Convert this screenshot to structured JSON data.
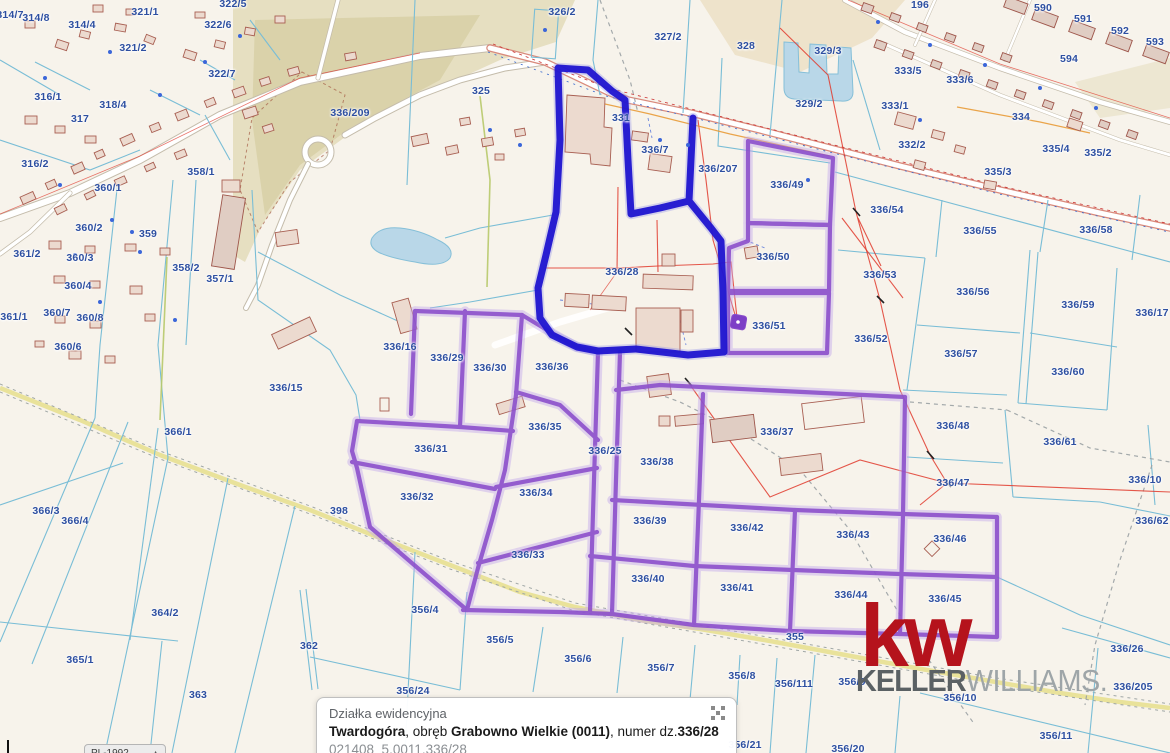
{
  "map": {
    "selected_parcel": "336/28",
    "selected_outline_color": "#1f14d0",
    "related_outline_color": "#8a4dcb",
    "label_color": "#2d4fa1",
    "labels": [
      {
        "t": "314/7",
        "x": 10,
        "y": 15
      },
      {
        "t": "314/8",
        "x": 36,
        "y": 18
      },
      {
        "t": "314/4",
        "x": 82,
        "y": 25
      },
      {
        "t": "321/1",
        "x": 145,
        "y": 12
      },
      {
        "t": "322/5",
        "x": 233,
        "y": 4
      },
      {
        "t": "322/6",
        "x": 218,
        "y": 25
      },
      {
        "t": "321/2",
        "x": 133,
        "y": 48
      },
      {
        "t": "322/7",
        "x": 222,
        "y": 74
      },
      {
        "t": "316/1",
        "x": 48,
        "y": 97
      },
      {
        "t": "318/4",
        "x": 113,
        "y": 105
      },
      {
        "t": "317",
        "x": 80,
        "y": 119
      },
      {
        "t": "316/2",
        "x": 35,
        "y": 164
      },
      {
        "t": "358/1",
        "x": 201,
        "y": 172
      },
      {
        "t": "360/1",
        "x": 108,
        "y": 188
      },
      {
        "t": "360/2",
        "x": 89,
        "y": 228
      },
      {
        "t": "359",
        "x": 148,
        "y": 234
      },
      {
        "t": "361/2",
        "x": 27,
        "y": 254
      },
      {
        "t": "360/3",
        "x": 80,
        "y": 258
      },
      {
        "t": "358/2",
        "x": 186,
        "y": 268
      },
      {
        "t": "357/1",
        "x": 220,
        "y": 279
      },
      {
        "t": "360/4",
        "x": 78,
        "y": 286
      },
      {
        "t": "360/7",
        "x": 57,
        "y": 313
      },
      {
        "t": "360/8",
        "x": 90,
        "y": 318
      },
      {
        "t": "361/1",
        "x": 14,
        "y": 317
      },
      {
        "t": "360/6",
        "x": 68,
        "y": 347
      },
      {
        "t": "336/15",
        "x": 286,
        "y": 388
      },
      {
        "t": "366/1",
        "x": 178,
        "y": 432
      },
      {
        "t": "366/3",
        "x": 46,
        "y": 511
      },
      {
        "t": "366/4",
        "x": 75,
        "y": 521
      },
      {
        "t": "364/2",
        "x": 165,
        "y": 613
      },
      {
        "t": "365/1",
        "x": 80,
        "y": 660
      },
      {
        "t": "362",
        "x": 309,
        "y": 646
      },
      {
        "t": "363",
        "x": 198,
        "y": 695
      },
      {
        "t": "398",
        "x": 339,
        "y": 511
      },
      {
        "t": "336/209",
        "x": 350,
        "y": 113
      },
      {
        "t": "325",
        "x": 481,
        "y": 91
      },
      {
        "t": "326/2",
        "x": 562,
        "y": 12
      },
      {
        "t": "327/2",
        "x": 668,
        "y": 37
      },
      {
        "t": "328",
        "x": 746,
        "y": 46
      },
      {
        "t": "329/2",
        "x": 809,
        "y": 104
      },
      {
        "t": "331",
        "x": 621,
        "y": 118
      },
      {
        "t": "336/7",
        "x": 655,
        "y": 150
      },
      {
        "t": "336/207",
        "x": 718,
        "y": 169
      },
      {
        "t": "336/49",
        "x": 787,
        "y": 185
      },
      {
        "t": "336/50",
        "x": 773,
        "y": 257
      },
      {
        "t": "336/51",
        "x": 769,
        "y": 326
      },
      {
        "t": "336/28",
        "x": 622,
        "y": 272
      },
      {
        "t": "196",
        "x": 920,
        "y": 5
      },
      {
        "t": "590",
        "x": 1043,
        "y": 8
      },
      {
        "t": "591",
        "x": 1083,
        "y": 19
      },
      {
        "t": "592",
        "x": 1120,
        "y": 31
      },
      {
        "t": "593",
        "x": 1155,
        "y": 42
      },
      {
        "t": "594",
        "x": 1069,
        "y": 59
      },
      {
        "t": "329/3",
        "x": 828,
        "y": 51
      },
      {
        "t": "333/5",
        "x": 908,
        "y": 71
      },
      {
        "t": "333/6",
        "x": 960,
        "y": 80
      },
      {
        "t": "333/1",
        "x": 895,
        "y": 106
      },
      {
        "t": "334",
        "x": 1021,
        "y": 117
      },
      {
        "t": "332/2",
        "x": 912,
        "y": 145
      },
      {
        "t": "335/4",
        "x": 1056,
        "y": 149
      },
      {
        "t": "335/2",
        "x": 1098,
        "y": 153
      },
      {
        "t": "335/3",
        "x": 998,
        "y": 172
      },
      {
        "t": "336/54",
        "x": 887,
        "y": 210
      },
      {
        "t": "336/55",
        "x": 980,
        "y": 231
      },
      {
        "t": "336/58",
        "x": 1096,
        "y": 230
      },
      {
        "t": "336/53",
        "x": 880,
        "y": 275
      },
      {
        "t": "336/56",
        "x": 973,
        "y": 292
      },
      {
        "t": "336/59",
        "x": 1078,
        "y": 305
      },
      {
        "t": "336/17",
        "x": 1152,
        "y": 313
      },
      {
        "t": "336/52",
        "x": 871,
        "y": 339
      },
      {
        "t": "336/57",
        "x": 961,
        "y": 354
      },
      {
        "t": "336/60",
        "x": 1068,
        "y": 372
      },
      {
        "t": "336/16",
        "x": 400,
        "y": 347
      },
      {
        "t": "336/29",
        "x": 447,
        "y": 358
      },
      {
        "t": "336/30",
        "x": 490,
        "y": 368
      },
      {
        "t": "336/36",
        "x": 552,
        "y": 367
      },
      {
        "t": "336/35",
        "x": 545,
        "y": 427
      },
      {
        "t": "336/31",
        "x": 431,
        "y": 449
      },
      {
        "t": "336/25",
        "x": 605,
        "y": 451
      },
      {
        "t": "336/38",
        "x": 657,
        "y": 462
      },
      {
        "t": "336/37",
        "x": 777,
        "y": 432
      },
      {
        "t": "336/48",
        "x": 953,
        "y": 426
      },
      {
        "t": "336/47",
        "x": 953,
        "y": 483
      },
      {
        "t": "336/61",
        "x": 1060,
        "y": 442
      },
      {
        "t": "336/10",
        "x": 1145,
        "y": 480
      },
      {
        "t": "336/62",
        "x": 1152,
        "y": 521
      },
      {
        "t": "336/32",
        "x": 417,
        "y": 497
      },
      {
        "t": "336/34",
        "x": 536,
        "y": 493
      },
      {
        "t": "336/33",
        "x": 528,
        "y": 555
      },
      {
        "t": "336/39",
        "x": 650,
        "y": 521
      },
      {
        "t": "336/40",
        "x": 648,
        "y": 579
      },
      {
        "t": "336/42",
        "x": 747,
        "y": 528
      },
      {
        "t": "336/41",
        "x": 737,
        "y": 588
      },
      {
        "t": "336/43",
        "x": 853,
        "y": 535
      },
      {
        "t": "336/44",
        "x": 851,
        "y": 595
      },
      {
        "t": "336/46",
        "x": 950,
        "y": 539
      },
      {
        "t": "336/45",
        "x": 945,
        "y": 599
      },
      {
        "t": "356/4",
        "x": 425,
        "y": 610
      },
      {
        "t": "355",
        "x": 795,
        "y": 637
      },
      {
        "t": "356/5",
        "x": 500,
        "y": 640
      },
      {
        "t": "356/6",
        "x": 578,
        "y": 659
      },
      {
        "t": "356/7",
        "x": 661,
        "y": 668
      },
      {
        "t": "356/8",
        "x": 742,
        "y": 676
      },
      {
        "t": "356/111",
        "x": 794,
        "y": 684
      },
      {
        "t": "356/9",
        "x": 852,
        "y": 682
      },
      {
        "t": "356/10",
        "x": 960,
        "y": 698
      },
      {
        "t": "336/26",
        "x": 1127,
        "y": 649
      },
      {
        "t": "336/205",
        "x": 1133,
        "y": 687
      },
      {
        "t": "356/11",
        "x": 1056,
        "y": 736
      },
      {
        "t": "356/21",
        "x": 745,
        "y": 745
      },
      {
        "t": "356/20",
        "x": 848,
        "y": 749
      },
      {
        "t": "356/24",
        "x": 413,
        "y": 691
      }
    ]
  },
  "popup": {
    "title": "Działka ewidencyjna",
    "town": "Twardogóra",
    "sep1": ", obręb ",
    "district": "Grabowno Wielkie (0011)",
    "sep2": ", numer dz.",
    "parcel_no": "336/28",
    "parcel_id": "021408_5.0011.336/28",
    "close_icon": "dissolve-x-icon"
  },
  "logo": {
    "mark": "kw",
    "name_bold": "KELLER",
    "name_light": "WILLIAMS",
    "dot": ".",
    "brand_color": "#b5131c"
  },
  "controls": {
    "crs_label": "PL-1992",
    "caret": "▲"
  }
}
